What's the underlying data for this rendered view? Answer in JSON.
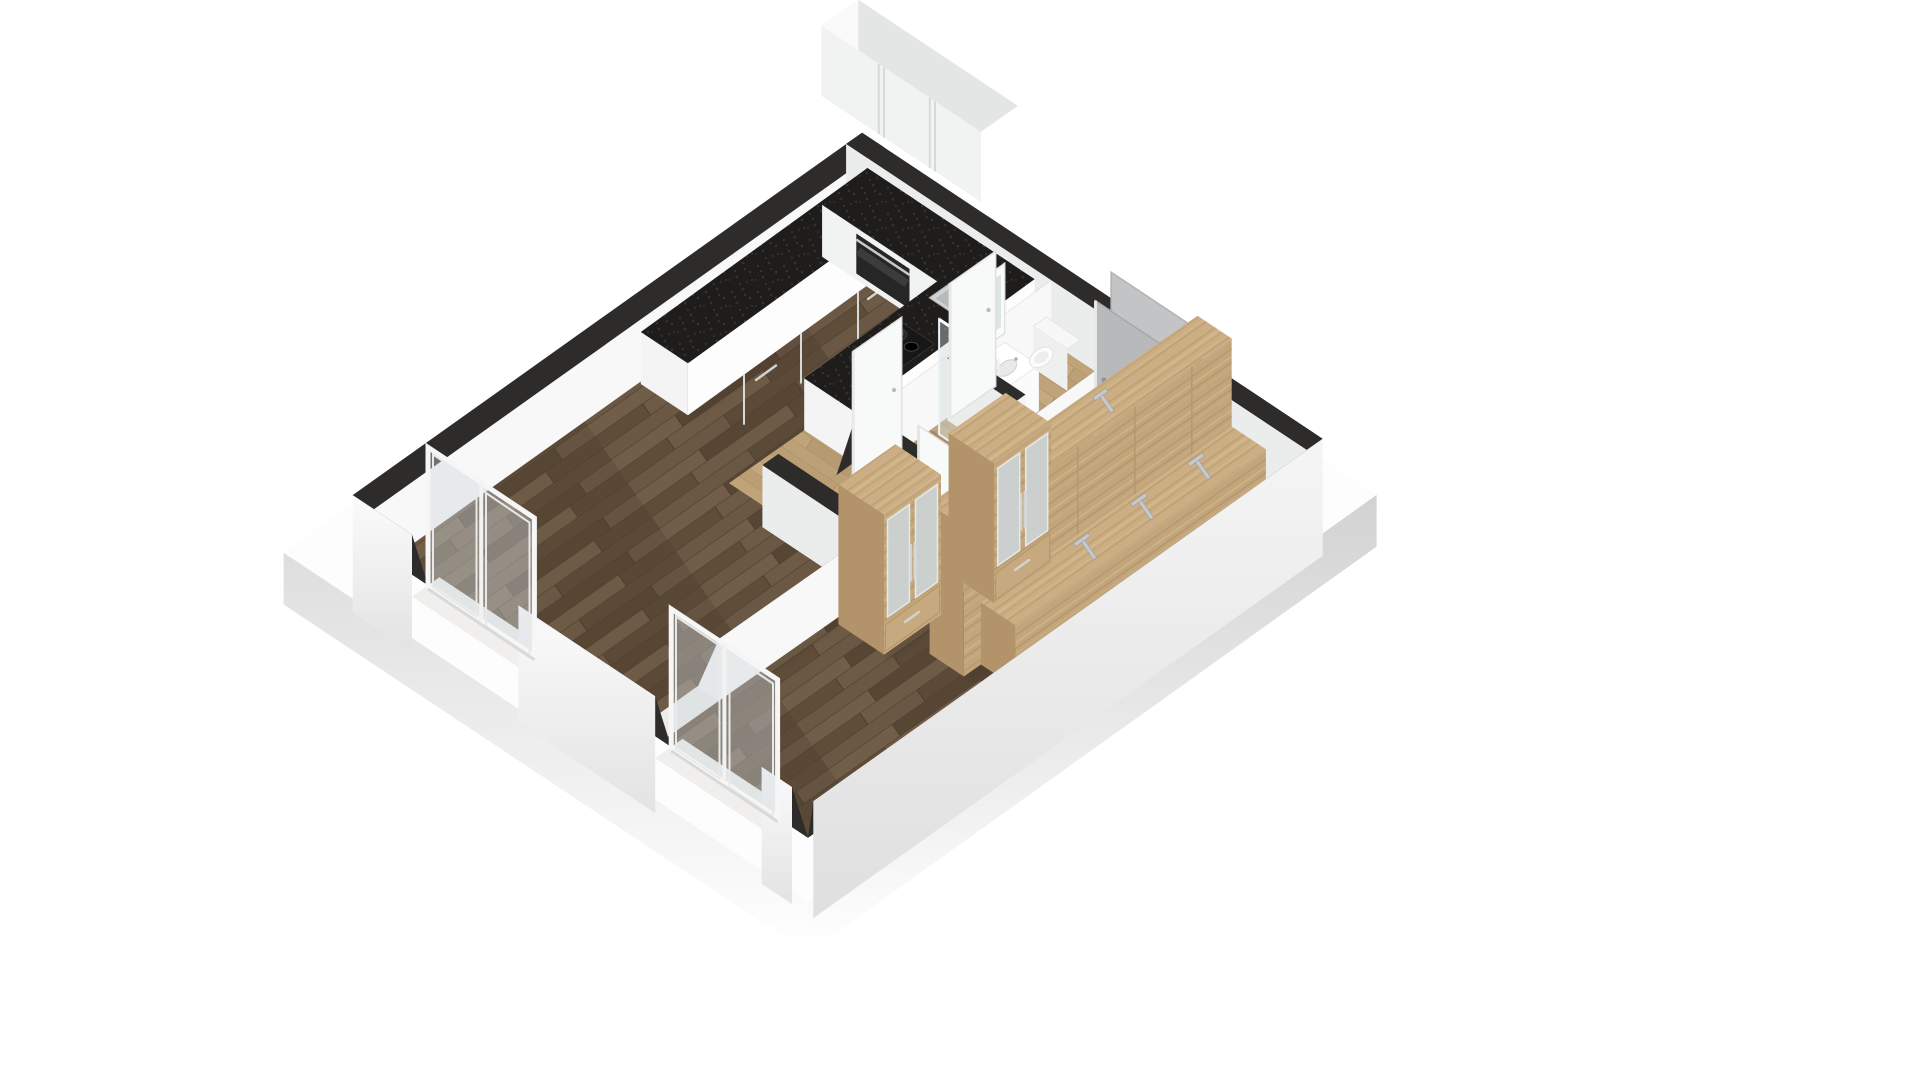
{
  "scene": {
    "type": "isometric-3d-floorplan-render",
    "description": "3D rendered floor plan of a one-bedroom apartment viewed from above on a white background; walls cut at waist height with dark top edges",
    "rooms": [
      {
        "name": "living-room-with-kitchen",
        "floor": "dark walnut planks"
      },
      {
        "name": "bedroom",
        "floor": "dark walnut planks"
      },
      {
        "name": "bathroom",
        "floor": "light cork tiles"
      },
      {
        "name": "hallway",
        "floor": "light cork tiles"
      }
    ],
    "objects": [
      "floating-upper-kitchen-cabinet",
      "l-shaped-kitchen-counter",
      "built-in-oven",
      "cooktop-with-two-pots",
      "stainless-sink",
      "kitchen-peninsula-counter",
      "shower-glass-panel",
      "washbasin-with-mirror-cabinet",
      "toilet",
      "open-white-interior-doors",
      "grey-door-leaves",
      "oak-wardrobe-with-mirror-doors-1",
      "oak-wardrobe-with-mirror-doors-2",
      "long-oak-wall-unit-with-handles",
      "sliding-glass-door-living-room",
      "sliding-glass-door-bedroom"
    ]
  },
  "colors": {
    "bg": "#ffffff",
    "wall_top": "#2e2c2a",
    "wall_face_bright": "#f8f8f8",
    "wall_face_shaded": "#ebecec",
    "floor_dark_wood": "#63513e",
    "floor_light_cork": "#c0a377",
    "countertop_black": "#1e1d1c",
    "cabinet_white": "#fdfdfd",
    "oak_wood": "#c9ac81",
    "oak_wood_shaded": "#b3946a",
    "door_grey": "#b7b9bb",
    "glass": "#cdd7dc",
    "slab_grey": "#d9d9d9",
    "stainless": "#cfd3d6"
  }
}
